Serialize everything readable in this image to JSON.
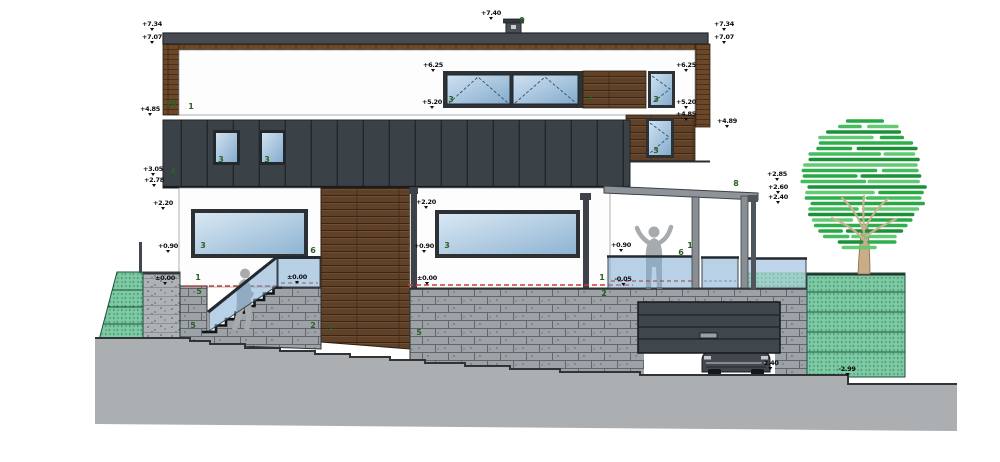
{
  "drawing": {
    "title": "house-side-elevation",
    "colors": {
      "roof": "#454b51",
      "cladding": "#3b4247",
      "wood": "#5f4028",
      "stone": "#9ca2a6",
      "green_wall": "#7cc9a4",
      "terrain": "#abafb2",
      "glass": "#8fb4d2",
      "level_line_red": "#d03a2e",
      "label_green": "#2d5f27",
      "foliage": "#27a844",
      "trunk": "#c9ac88",
      "silhouette": "#a7abae"
    }
  },
  "elevation_markers": [
    {
      "value": "+7.34",
      "x": 152,
      "y": 21
    },
    {
      "value": "+7.07",
      "x": 152,
      "y": 34
    },
    {
      "value": "+4.85",
      "x": 150,
      "y": 106
    },
    {
      "value": "+3.05",
      "x": 153,
      "y": 166
    },
    {
      "value": "+2.78",
      "x": 154,
      "y": 177
    },
    {
      "value": "+2.20",
      "x": 163,
      "y": 200
    },
    {
      "value": "+0.90",
      "x": 168,
      "y": 243
    },
    {
      "value": "±0.00",
      "x": 165,
      "y": 275
    },
    {
      "value": "+7.40",
      "x": 491,
      "y": 10
    },
    {
      "value": "+6.25",
      "x": 433,
      "y": 62
    },
    {
      "value": "+5.20",
      "x": 432,
      "y": 99
    },
    {
      "value": "+2.20",
      "x": 426,
      "y": 199
    },
    {
      "value": "+0.90",
      "x": 424,
      "y": 243
    },
    {
      "value": "±0.00",
      "x": 427,
      "y": 275
    },
    {
      "value": "+6.25",
      "x": 686,
      "y": 62
    },
    {
      "value": "+5.20",
      "x": 686,
      "y": 99
    },
    {
      "value": "+4.85",
      "x": 686,
      "y": 111
    },
    {
      "value": "+7.34",
      "x": 724,
      "y": 21
    },
    {
      "value": "+7.07",
      "x": 724,
      "y": 34
    },
    {
      "value": "+4.89",
      "x": 727,
      "y": 118
    },
    {
      "value": "+2.85",
      "x": 777,
      "y": 171
    },
    {
      "value": "+2.60",
      "x": 778,
      "y": 184
    },
    {
      "value": "+2.40",
      "x": 778,
      "y": 194
    },
    {
      "value": "+0.90",
      "x": 621,
      "y": 242
    },
    {
      "value": "-0.05",
      "x": 623,
      "y": 276
    },
    {
      "value": "±0.00",
      "x": 297,
      "y": 274
    },
    {
      "value": "-2.40",
      "x": 770,
      "y": 360
    },
    {
      "value": "-2.99",
      "x": 847,
      "y": 366
    }
  ],
  "reference_labels": [
    {
      "value": "10",
      "x": 171,
      "y": 104
    },
    {
      "value": "1",
      "x": 191,
      "y": 107
    },
    {
      "value": "3",
      "x": 451,
      "y": 100
    },
    {
      "value": "7",
      "x": 590,
      "y": 100
    },
    {
      "value": "3",
      "x": 656,
      "y": 100
    },
    {
      "value": "9",
      "x": 522,
      "y": 21
    },
    {
      "value": "8",
      "x": 736,
      "y": 184
    },
    {
      "value": "4",
      "x": 173,
      "y": 172
    },
    {
      "value": "3",
      "x": 221,
      "y": 160
    },
    {
      "value": "3",
      "x": 267,
      "y": 160
    },
    {
      "value": "3",
      "x": 656,
      "y": 151
    },
    {
      "value": "3",
      "x": 203,
      "y": 246
    },
    {
      "value": "3",
      "x": 447,
      "y": 246
    },
    {
      "value": "6",
      "x": 313,
      "y": 251
    },
    {
      "value": "1",
      "x": 198,
      "y": 278
    },
    {
      "value": "5",
      "x": 199,
      "y": 292
    },
    {
      "value": "5",
      "x": 193,
      "y": 326
    },
    {
      "value": "2",
      "x": 313,
      "y": 326
    },
    {
      "value": "7",
      "x": 330,
      "y": 330
    },
    {
      "value": "5",
      "x": 419,
      "y": 333
    },
    {
      "value": "1",
      "x": 602,
      "y": 278
    },
    {
      "value": "6",
      "x": 681,
      "y": 253
    },
    {
      "value": "1",
      "x": 690,
      "y": 246
    },
    {
      "value": "2",
      "x": 604,
      "y": 294
    }
  ]
}
